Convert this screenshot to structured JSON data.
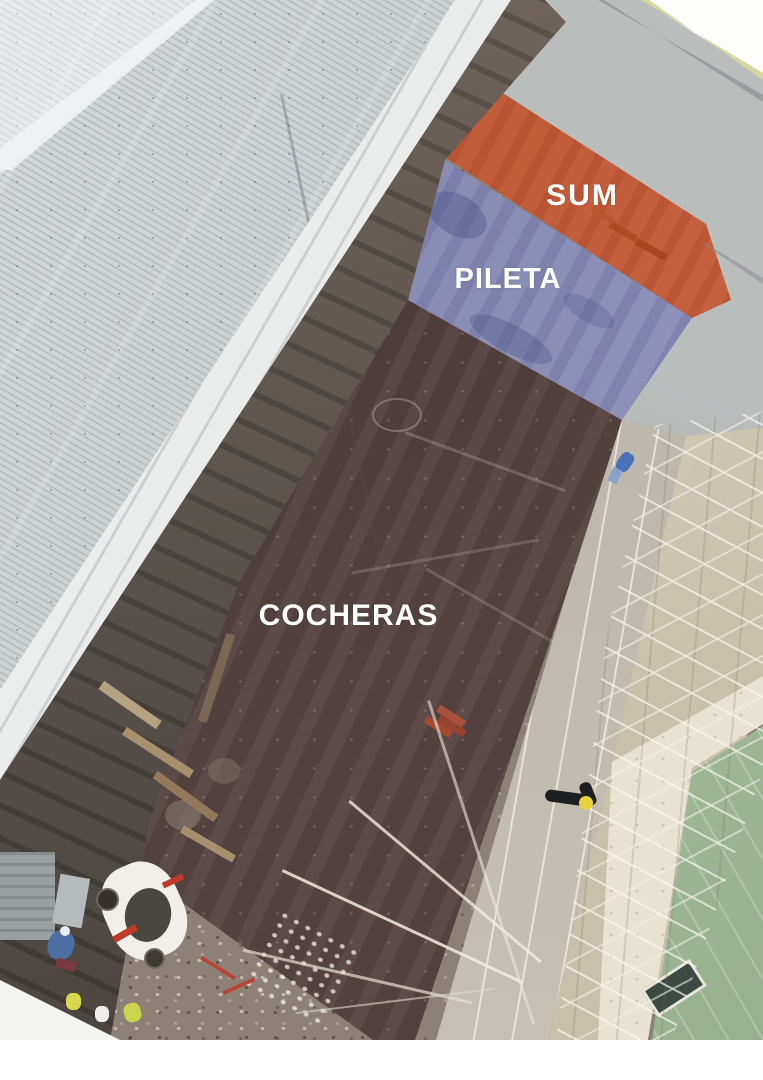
{
  "image": {
    "kind": "aerial-construction-site-photo-with-zone-overlays",
    "background": "#ffffff"
  },
  "zones": [
    {
      "id": "sum",
      "label": "SUM",
      "color": "#c65a35"
    },
    {
      "id": "pileta",
      "label": "PILETA",
      "color": "#8a8db8"
    },
    {
      "id": "cocheras",
      "label": "COCHERAS",
      "color": "#53413f"
    }
  ],
  "label_style": {
    "text_color": "#ffffff"
  }
}
